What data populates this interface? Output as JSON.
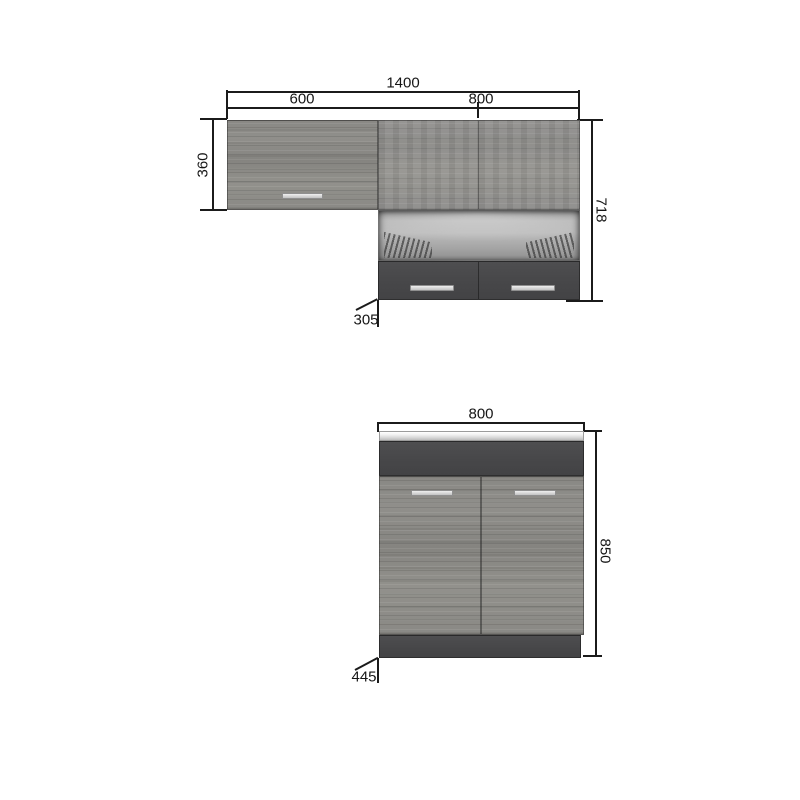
{
  "diagrams": {
    "wall_cabinets": {
      "dims": {
        "total_width": "1400",
        "left_section_width": "600",
        "right_section_width": "800",
        "left_cabinet_height": "360",
        "right_section_height": "718",
        "depth": "305"
      }
    },
    "base_cabinet": {
      "dims": {
        "width": "800",
        "height": "850",
        "depth": "445"
      }
    }
  },
  "palette": {
    "wood": "#8d8c89",
    "dark_panel": "#48484a",
    "handle": "#d9d9d9",
    "countertop": "#e9e9e9",
    "dimension_line": "#1b1b1b",
    "background": "#ffffff"
  }
}
